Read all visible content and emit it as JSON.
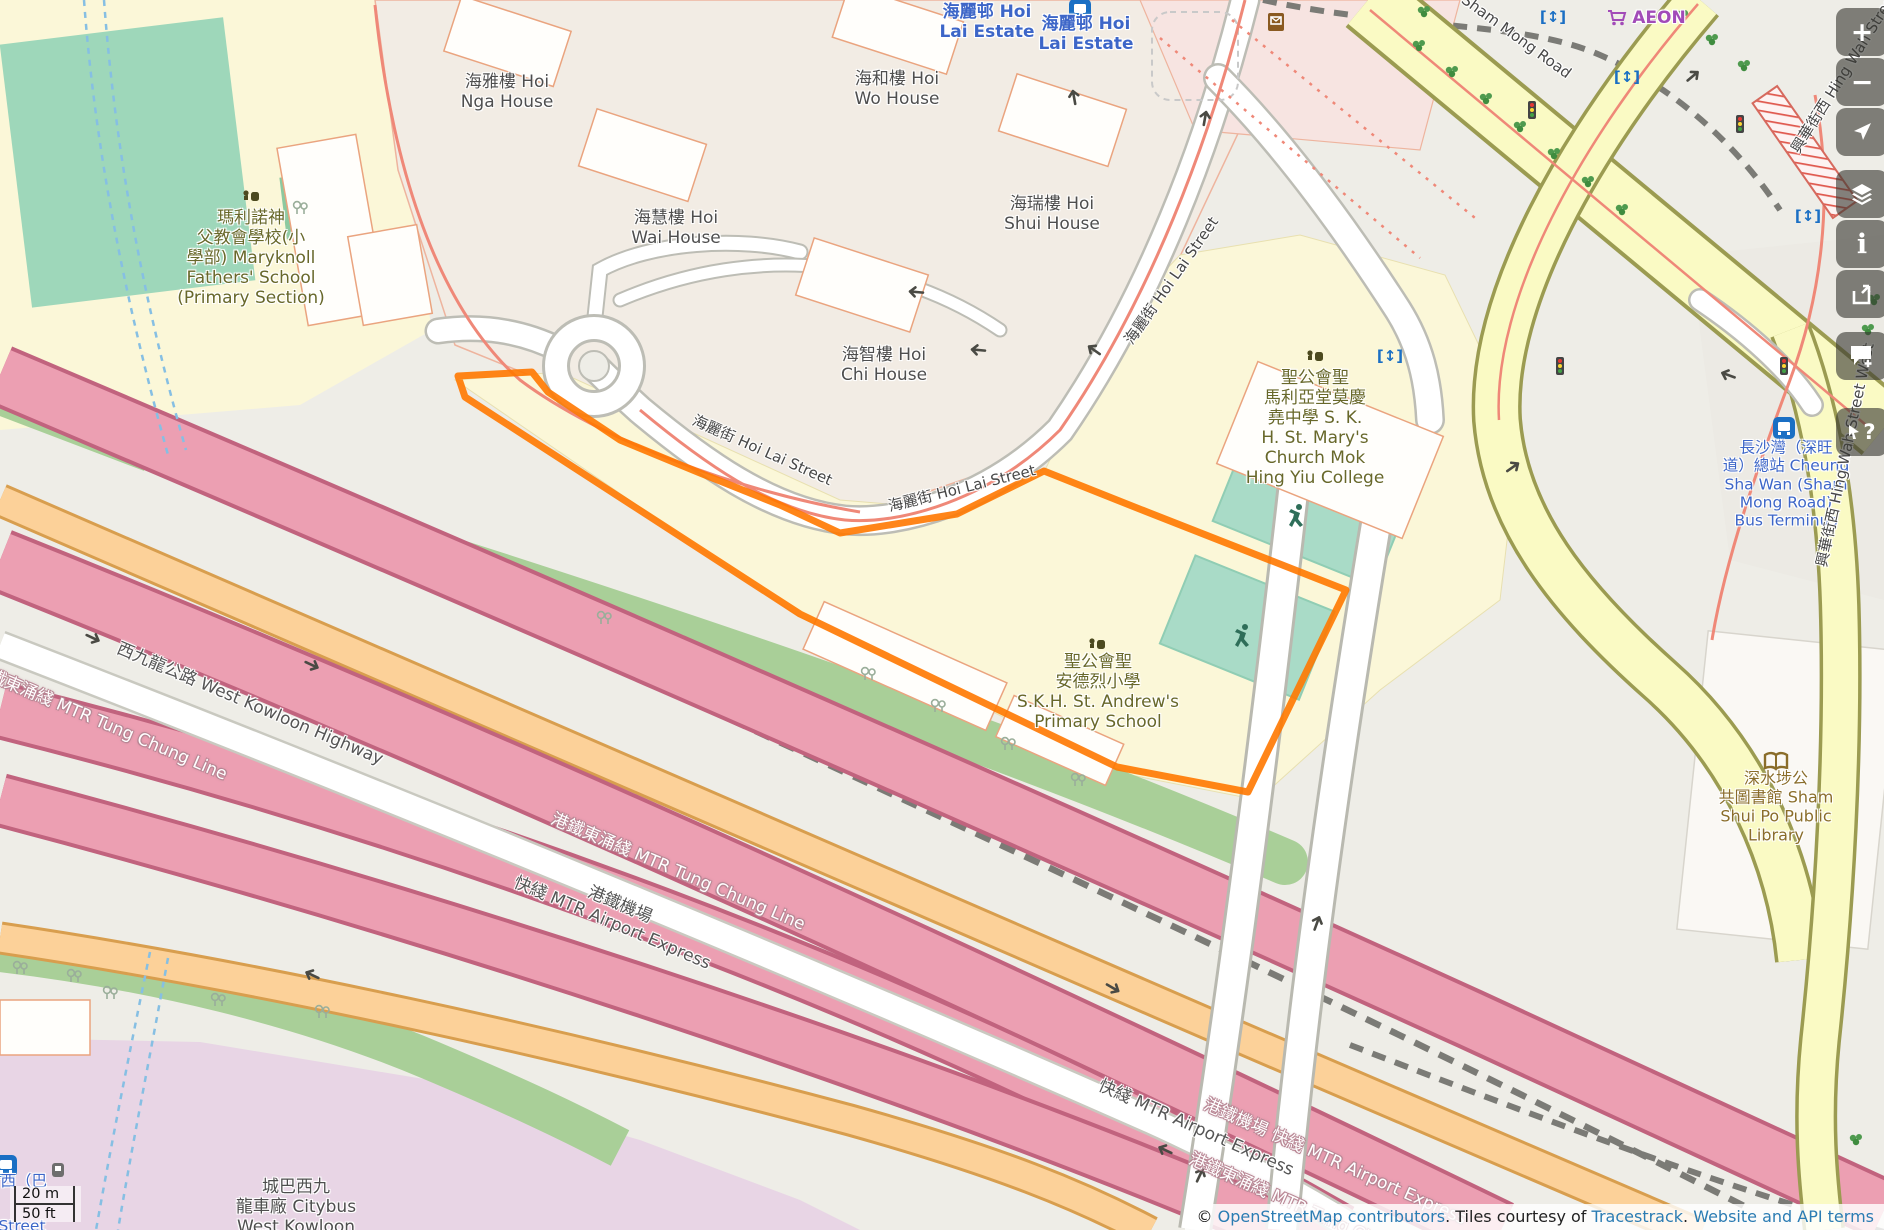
{
  "controls": {
    "zoom_in": "+",
    "zoom_out": "−",
    "info": "i",
    "query": "?"
  },
  "scale_bar": {
    "metric": "20 m",
    "imperial": "50 ft"
  },
  "attribution": {
    "prefix": "©",
    "osm_link": "OpenStreetMap contributors",
    "middle": ". Tiles courtesy of",
    "tracestrack_link": "Tracestrack",
    "sep": ". ",
    "terms_link": "Website and API terms"
  },
  "colors": {
    "selection_orange": "#ff7800",
    "motorway_pink": "#ec9fb2",
    "trunk_orange": "#fcd199",
    "secondary_yellow": "#fafac4",
    "route_salmon": "#ef8878",
    "water_blue": "#86bfe3",
    "pitch_teal": "#a9dbc7",
    "grass_green": "#a9cf98",
    "depot_purple": "#e8d5e5",
    "estate_label_blue": "#3d66c8",
    "school_label_olive": "#68682a",
    "library_brown": "#8a6d2a",
    "shop_purple": "#a24bb8",
    "link_blue": "#2b7cb3"
  },
  "labels": [
    {
      "id": "maryknoll-school",
      "cls": "school",
      "x": 251,
      "y": 258,
      "rot": 0,
      "lines": [
        "瑪利諾神",
        "父教會學校(小",
        "學部) Maryknoll",
        "Fathers' School",
        "(Primary Section)"
      ]
    },
    {
      "id": "hoi-nga-house",
      "cls": "building-label",
      "x": 507,
      "y": 92,
      "rot": 0,
      "lines": [
        "海雅樓 Hoi",
        "Nga House"
      ]
    },
    {
      "id": "hoi-wo-house",
      "cls": "building-label",
      "x": 897,
      "y": 89,
      "rot": 0,
      "lines": [
        "海和樓 Hoi",
        "Wo House"
      ]
    },
    {
      "id": "hoi-wai-house",
      "cls": "building-label",
      "x": 676,
      "y": 228,
      "rot": 0,
      "lines": [
        "海慧樓 Hoi",
        "Wai House"
      ]
    },
    {
      "id": "hoi-shui-house",
      "cls": "building-label",
      "x": 1052,
      "y": 214,
      "rot": 0,
      "lines": [
        "海瑞樓 Hoi",
        "Shui House"
      ]
    },
    {
      "id": "hoi-chi-house",
      "cls": "building-label",
      "x": 884,
      "y": 365,
      "rot": 0,
      "lines": [
        "海智樓 Hoi",
        "Chi House"
      ]
    },
    {
      "id": "hoi-lai-estate-1",
      "cls": "estate",
      "x": 987,
      "y": 22,
      "rot": 0,
      "lines": [
        "海麗邨 Hoi",
        "Lai Estate"
      ]
    },
    {
      "id": "hoi-lai-estate-2",
      "cls": "estate",
      "x": 1086,
      "y": 34,
      "rot": 0,
      "lines": [
        "海麗邨 Hoi",
        "Lai Estate"
      ]
    },
    {
      "id": "st-marys-college",
      "cls": "school",
      "x": 1315,
      "y": 428,
      "rot": 0,
      "lines": [
        "聖公會聖",
        "馬利亞堂莫慶",
        "堯中學 S. K.",
        "H. St. Mary's",
        "Church Mok",
        "Hing Yiu College"
      ]
    },
    {
      "id": "st-andrews-primary-school",
      "cls": "school",
      "x": 1098,
      "y": 692,
      "rot": 0,
      "lines": [
        "聖公會聖",
        "安德烈小學",
        "S.K.H. St. Andrew's",
        "Primary School"
      ]
    },
    {
      "id": "sham-shui-po-library",
      "cls": "library",
      "x": 1776,
      "y": 807,
      "rot": 0,
      "lines": [
        "深水埗公",
        "共圖書館 Sham",
        "Shui Po Public",
        "Library"
      ]
    },
    {
      "id": "cheung-sha-wan-bus-terminus",
      "cls": "transport",
      "x": 1786,
      "y": 484,
      "rot": 0,
      "lines": [
        "長沙灣（深旺",
        "道）總站 Cheung",
        "Sha Wan (Sham",
        "Mong Road)",
        "Bus Terminus"
      ]
    },
    {
      "id": "citybus-west-kowloon-depot",
      "cls": "building-label",
      "x": 296,
      "y": 1207,
      "rot": 0,
      "lines": [
        "城巴西九",
        "龍車廠 Citybus",
        "West Kowloon"
      ]
    },
    {
      "id": "west-kowloon-highway",
      "cls": "road-dark",
      "x": 250,
      "y": 704,
      "rot": 23,
      "lines": [
        "西九龍公路 West Kowloon Highway"
      ]
    },
    {
      "id": "mtr-tung-chung-line-left",
      "cls": "rail-white",
      "x": 100,
      "y": 722,
      "rot": 23,
      "lines": [
        "港鐵東涌綫 MTR Tung Chung Line"
      ]
    },
    {
      "id": "mtr-tung-chung-line-mid",
      "cls": "rail-white",
      "x": 678,
      "y": 872,
      "rot": 23,
      "lines": [
        "港鐵東涌綫 MTR Tung Chung Line"
      ]
    },
    {
      "id": "mtr-airport-express-mid",
      "cls": "road-dark",
      "x": 616,
      "y": 914,
      "rot": 23,
      "lines": [
        "港鐵機場",
        "快綫 MTR Airport Express"
      ]
    },
    {
      "id": "mtr-airport-express-grey-br",
      "cls": "road-dark",
      "x": 1196,
      "y": 1128,
      "rot": 24,
      "lines": [
        "快綫 MTR Airport Express"
      ]
    },
    {
      "id": "mtr-airport-express-white-br",
      "cls": "rail-white",
      "x": 1335,
      "y": 1162,
      "rot": 24,
      "lines": [
        "港鐵機場 快綫 MTR Airport Express"
      ]
    },
    {
      "id": "mtr-tung-chung-line-br",
      "cls": "rail-white",
      "x": 1315,
      "y": 1214,
      "rot": 24,
      "lines": [
        "港鐵東涌綫 MTR Tung Chung Line"
      ]
    },
    {
      "id": "hoi-lai-street-1",
      "cls": "street",
      "x": 762,
      "y": 451,
      "rot": 24,
      "lines": [
        "海麗街 Hoi Lai Street"
      ]
    },
    {
      "id": "hoi-lai-street-2",
      "cls": "street",
      "x": 962,
      "y": 489,
      "rot": -14,
      "lines": [
        "海麗街 Hoi Lai Street"
      ]
    },
    {
      "id": "hoi-lai-street-3",
      "cls": "street",
      "x": 1172,
      "y": 281,
      "rot": -55,
      "lines": [
        "海麗街 Hoi Lai Street"
      ]
    },
    {
      "id": "sham-mong-road",
      "cls": "street",
      "x": 1516,
      "y": 37,
      "rot": 36,
      "lines": [
        "Sham Mong Road"
      ]
    },
    {
      "id": "hing-wah-street-west-top",
      "cls": "street",
      "x": 1856,
      "y": 55,
      "rot": -58,
      "lines": [
        "興華街西 Hing Wah Street West"
      ]
    },
    {
      "id": "hing-wah-street-west-right",
      "cls": "street",
      "x": 1846,
      "y": 455,
      "rot": -78,
      "lines": [
        "興華街西 Hing Wah Street West"
      ]
    },
    {
      "id": "aeon-store",
      "cls": "shop",
      "x": 1659,
      "y": 18,
      "rot": 0,
      "lines": [
        "AEON"
      ]
    },
    {
      "id": "edge-fragment-1",
      "cls": "transport",
      "x": 16,
      "y": 1181,
      "rot": 0,
      "lines": [
        "街西（巴"
      ]
    },
    {
      "id": "edge-fragment-2",
      "cls": "transport",
      "x": 22,
      "y": 1226,
      "rot": 0,
      "lines": [
        "Street"
      ]
    }
  ],
  "icons": [
    {
      "t": "school-icon",
      "x": 251,
      "y": 196,
      "r": 0
    },
    {
      "t": "school-icon",
      "x": 1315,
      "y": 356,
      "r": 0
    },
    {
      "t": "school-icon",
      "x": 1097,
      "y": 644,
      "r": 0
    },
    {
      "t": "book-icon",
      "x": 1776,
      "y": 762,
      "r": 0
    },
    {
      "t": "bus-icon",
      "x": 1080,
      "y": 10,
      "r": 0
    },
    {
      "t": "bus-icon",
      "x": 1784,
      "y": 428,
      "r": 0
    },
    {
      "t": "bus-icon",
      "x": 6,
      "y": 1166,
      "r": 0
    },
    {
      "t": "bus-stop-icon",
      "x": 58,
      "y": 1170,
      "r": 0
    },
    {
      "t": "cart-icon",
      "x": 1617,
      "y": 17,
      "r": 0
    },
    {
      "t": "postbox-icon",
      "x": 1276,
      "y": 22,
      "r": 0
    },
    {
      "t": "runner-icon",
      "x": 1296,
      "y": 516,
      "r": 0
    },
    {
      "t": "runner-icon",
      "x": 1242,
      "y": 636,
      "r": 0
    },
    {
      "t": "signal-icon",
      "x": 1532,
      "y": 110,
      "r": 0
    },
    {
      "t": "signal-icon",
      "x": 1740,
      "y": 124,
      "r": 0
    },
    {
      "t": "signal-icon",
      "x": 1560,
      "y": 366,
      "r": 0
    },
    {
      "t": "signal-icon",
      "x": 1784,
      "y": 366,
      "r": 0
    },
    {
      "t": "lift-icon",
      "x": 1553,
      "y": 17,
      "r": 0
    },
    {
      "t": "lift-icon",
      "x": 1627,
      "y": 77,
      "r": 0
    },
    {
      "t": "lift-icon",
      "x": 1808,
      "y": 216,
      "r": 0
    },
    {
      "t": "lift-icon",
      "x": 1390,
      "y": 356,
      "r": 0
    },
    {
      "t": "tree-icon",
      "x": 1424,
      "y": 12,
      "r": 0
    },
    {
      "t": "tree-icon",
      "x": 1419,
      "y": 46,
      "r": 0
    },
    {
      "t": "tree-icon",
      "x": 1452,
      "y": 72,
      "r": 0
    },
    {
      "t": "tree-icon",
      "x": 1486,
      "y": 99,
      "r": 0
    },
    {
      "t": "tree-icon",
      "x": 1520,
      "y": 127,
      "r": 0
    },
    {
      "t": "tree-icon",
      "x": 1554,
      "y": 154,
      "r": 0
    },
    {
      "t": "tree-icon",
      "x": 1588,
      "y": 182,
      "r": 0
    },
    {
      "t": "tree-icon",
      "x": 1622,
      "y": 210,
      "r": 0
    },
    {
      "t": "tree-icon",
      "x": 1682,
      "y": 16,
      "r": 0
    },
    {
      "t": "tree-icon",
      "x": 1712,
      "y": 40,
      "r": 0
    },
    {
      "t": "tree-icon",
      "x": 1744,
      "y": 66,
      "r": 0
    },
    {
      "t": "tree-icon",
      "x": 1868,
      "y": 330,
      "r": 0
    },
    {
      "t": "tree-icon",
      "x": 1874,
      "y": 300,
      "r": 0
    },
    {
      "t": "tree-icon",
      "x": 1856,
      "y": 1140,
      "r": 0
    },
    {
      "t": "tree-grey-icon",
      "x": 868,
      "y": 674,
      "r": 0
    },
    {
      "t": "tree-grey-icon",
      "x": 938,
      "y": 706,
      "r": 0
    },
    {
      "t": "tree-grey-icon",
      "x": 1008,
      "y": 744,
      "r": 0
    },
    {
      "t": "tree-grey-icon",
      "x": 1078,
      "y": 780,
      "r": 0
    },
    {
      "t": "tree-grey-icon",
      "x": 604,
      "y": 618,
      "r": 0
    },
    {
      "t": "tree-grey-icon",
      "x": 20,
      "y": 968,
      "r": 0
    },
    {
      "t": "tree-grey-icon",
      "x": 74,
      "y": 976,
      "r": 0
    },
    {
      "t": "tree-grey-icon",
      "x": 110,
      "y": 993,
      "r": 0
    },
    {
      "t": "tree-grey-icon",
      "x": 218,
      "y": 1000,
      "r": 0
    },
    {
      "t": "tree-grey-icon",
      "x": 322,
      "y": 1012,
      "r": 0
    },
    {
      "t": "tree-grey-icon",
      "x": 300,
      "y": 208,
      "r": 0
    },
    {
      "t": "arrow-icon",
      "x": 1094,
      "y": 350,
      "r": 215
    },
    {
      "t": "arrow-icon",
      "x": 1205,
      "y": 118,
      "r": -80
    },
    {
      "t": "arrow-icon",
      "x": 916,
      "y": 292,
      "r": 185
    },
    {
      "t": "arrow-icon",
      "x": 978,
      "y": 350,
      "r": 185
    },
    {
      "t": "arrow-icon",
      "x": 93,
      "y": 638,
      "r": 25
    },
    {
      "t": "arrow-icon",
      "x": 312,
      "y": 665,
      "r": 25
    },
    {
      "t": "arrow-icon",
      "x": 312,
      "y": 975,
      "r": 205
    },
    {
      "t": "arrow-icon",
      "x": 1113,
      "y": 988,
      "r": 30
    },
    {
      "t": "arrow-icon",
      "x": 1165,
      "y": 1150,
      "r": 205
    },
    {
      "t": "arrow-icon",
      "x": 1200,
      "y": 1175,
      "r": -65
    },
    {
      "t": "arrow-icon",
      "x": 1693,
      "y": 76,
      "r": -40
    },
    {
      "t": "arrow-icon",
      "x": 1728,
      "y": 375,
      "r": 200
    },
    {
      "t": "arrow-icon",
      "x": 1513,
      "y": 467,
      "r": -35
    },
    {
      "t": "arrow-icon",
      "x": 1317,
      "y": 923,
      "r": -70
    },
    {
      "t": "arrow-icon",
      "x": 1074,
      "y": 97,
      "r": -100
    }
  ]
}
